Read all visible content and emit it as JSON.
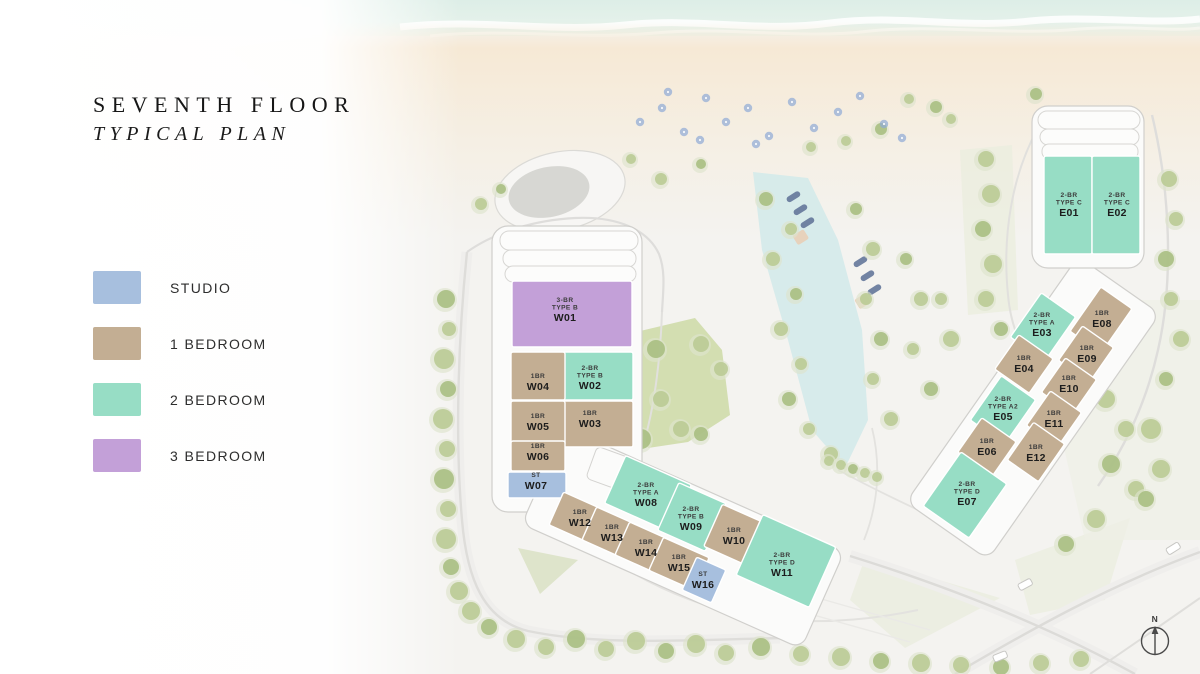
{
  "title": {
    "line1": "SEVENTH FLOOR",
    "line2": "TYPICAL PLAN"
  },
  "legend": {
    "items": [
      {
        "key": "studio",
        "label": "STUDIO",
        "color": "#a7bfde"
      },
      {
        "key": "1br",
        "label": "1 BEDROOM",
        "color": "#c3ae93"
      },
      {
        "key": "2br",
        "label": "2 BEDROOM",
        "color": "#97ddc5"
      },
      {
        "key": "3br",
        "label": "3 BEDROOM",
        "color": "#c3a0d8"
      }
    ]
  },
  "plan": {
    "units": [
      {
        "id": "W01",
        "lines": [
          "3-BR",
          "TYPE B"
        ],
        "category": "3br"
      },
      {
        "id": "W02",
        "lines": [
          "2-BR",
          "TYPE B"
        ],
        "category": "2br"
      },
      {
        "id": "W03",
        "lines": [
          "1BR"
        ],
        "category": "1br"
      },
      {
        "id": "W04",
        "lines": [
          "1BR"
        ],
        "category": "1br"
      },
      {
        "id": "W05",
        "lines": [
          "1BR"
        ],
        "category": "1br"
      },
      {
        "id": "W06",
        "lines": [
          "1BR"
        ],
        "category": "1br"
      },
      {
        "id": "W07",
        "lines": [
          "ST"
        ],
        "category": "studio"
      },
      {
        "id": "W08",
        "lines": [
          "2-BR",
          "TYPE A"
        ],
        "category": "2br"
      },
      {
        "id": "W09",
        "lines": [
          "2-BR",
          "TYPE B"
        ],
        "category": "2br"
      },
      {
        "id": "W10",
        "lines": [
          "1BR"
        ],
        "category": "1br"
      },
      {
        "id": "W11",
        "lines": [
          "2-BR",
          "TYPE D"
        ],
        "category": "2br"
      },
      {
        "id": "W12",
        "lines": [
          "1BR"
        ],
        "category": "1br"
      },
      {
        "id": "W13",
        "lines": [
          "1BR"
        ],
        "category": "1br"
      },
      {
        "id": "W14",
        "lines": [
          "1BR"
        ],
        "category": "1br"
      },
      {
        "id": "W15",
        "lines": [
          "1BR"
        ],
        "category": "1br"
      },
      {
        "id": "W16",
        "lines": [
          "ST"
        ],
        "category": "studio"
      },
      {
        "id": "E01",
        "lines": [
          "2-BR",
          "TYPE C"
        ],
        "category": "2br"
      },
      {
        "id": "E02",
        "lines": [
          "2-BR",
          "TYPE C"
        ],
        "category": "2br"
      },
      {
        "id": "E03",
        "lines": [
          "2-BR",
          "TYPE A"
        ],
        "category": "2br"
      },
      {
        "id": "E04",
        "lines": [
          "1BR"
        ],
        "category": "1br"
      },
      {
        "id": "E05",
        "lines": [
          "2-BR",
          "TYPE A2"
        ],
        "category": "2br"
      },
      {
        "id": "E06",
        "lines": [
          "1BR"
        ],
        "category": "1br"
      },
      {
        "id": "E07",
        "lines": [
          "2-BR",
          "TYPE D"
        ],
        "category": "2br"
      },
      {
        "id": "E08",
        "lines": [
          "1BR"
        ],
        "category": "1br"
      },
      {
        "id": "E09",
        "lines": [
          "1BR"
        ],
        "category": "1br"
      },
      {
        "id": "E10",
        "lines": [
          "1BR"
        ],
        "category": "1br"
      },
      {
        "id": "E11",
        "lines": [
          "1BR"
        ],
        "category": "1br"
      },
      {
        "id": "E12",
        "lines": [
          "1BR"
        ],
        "category": "1br"
      }
    ]
  },
  "compass": {
    "label": "N"
  }
}
